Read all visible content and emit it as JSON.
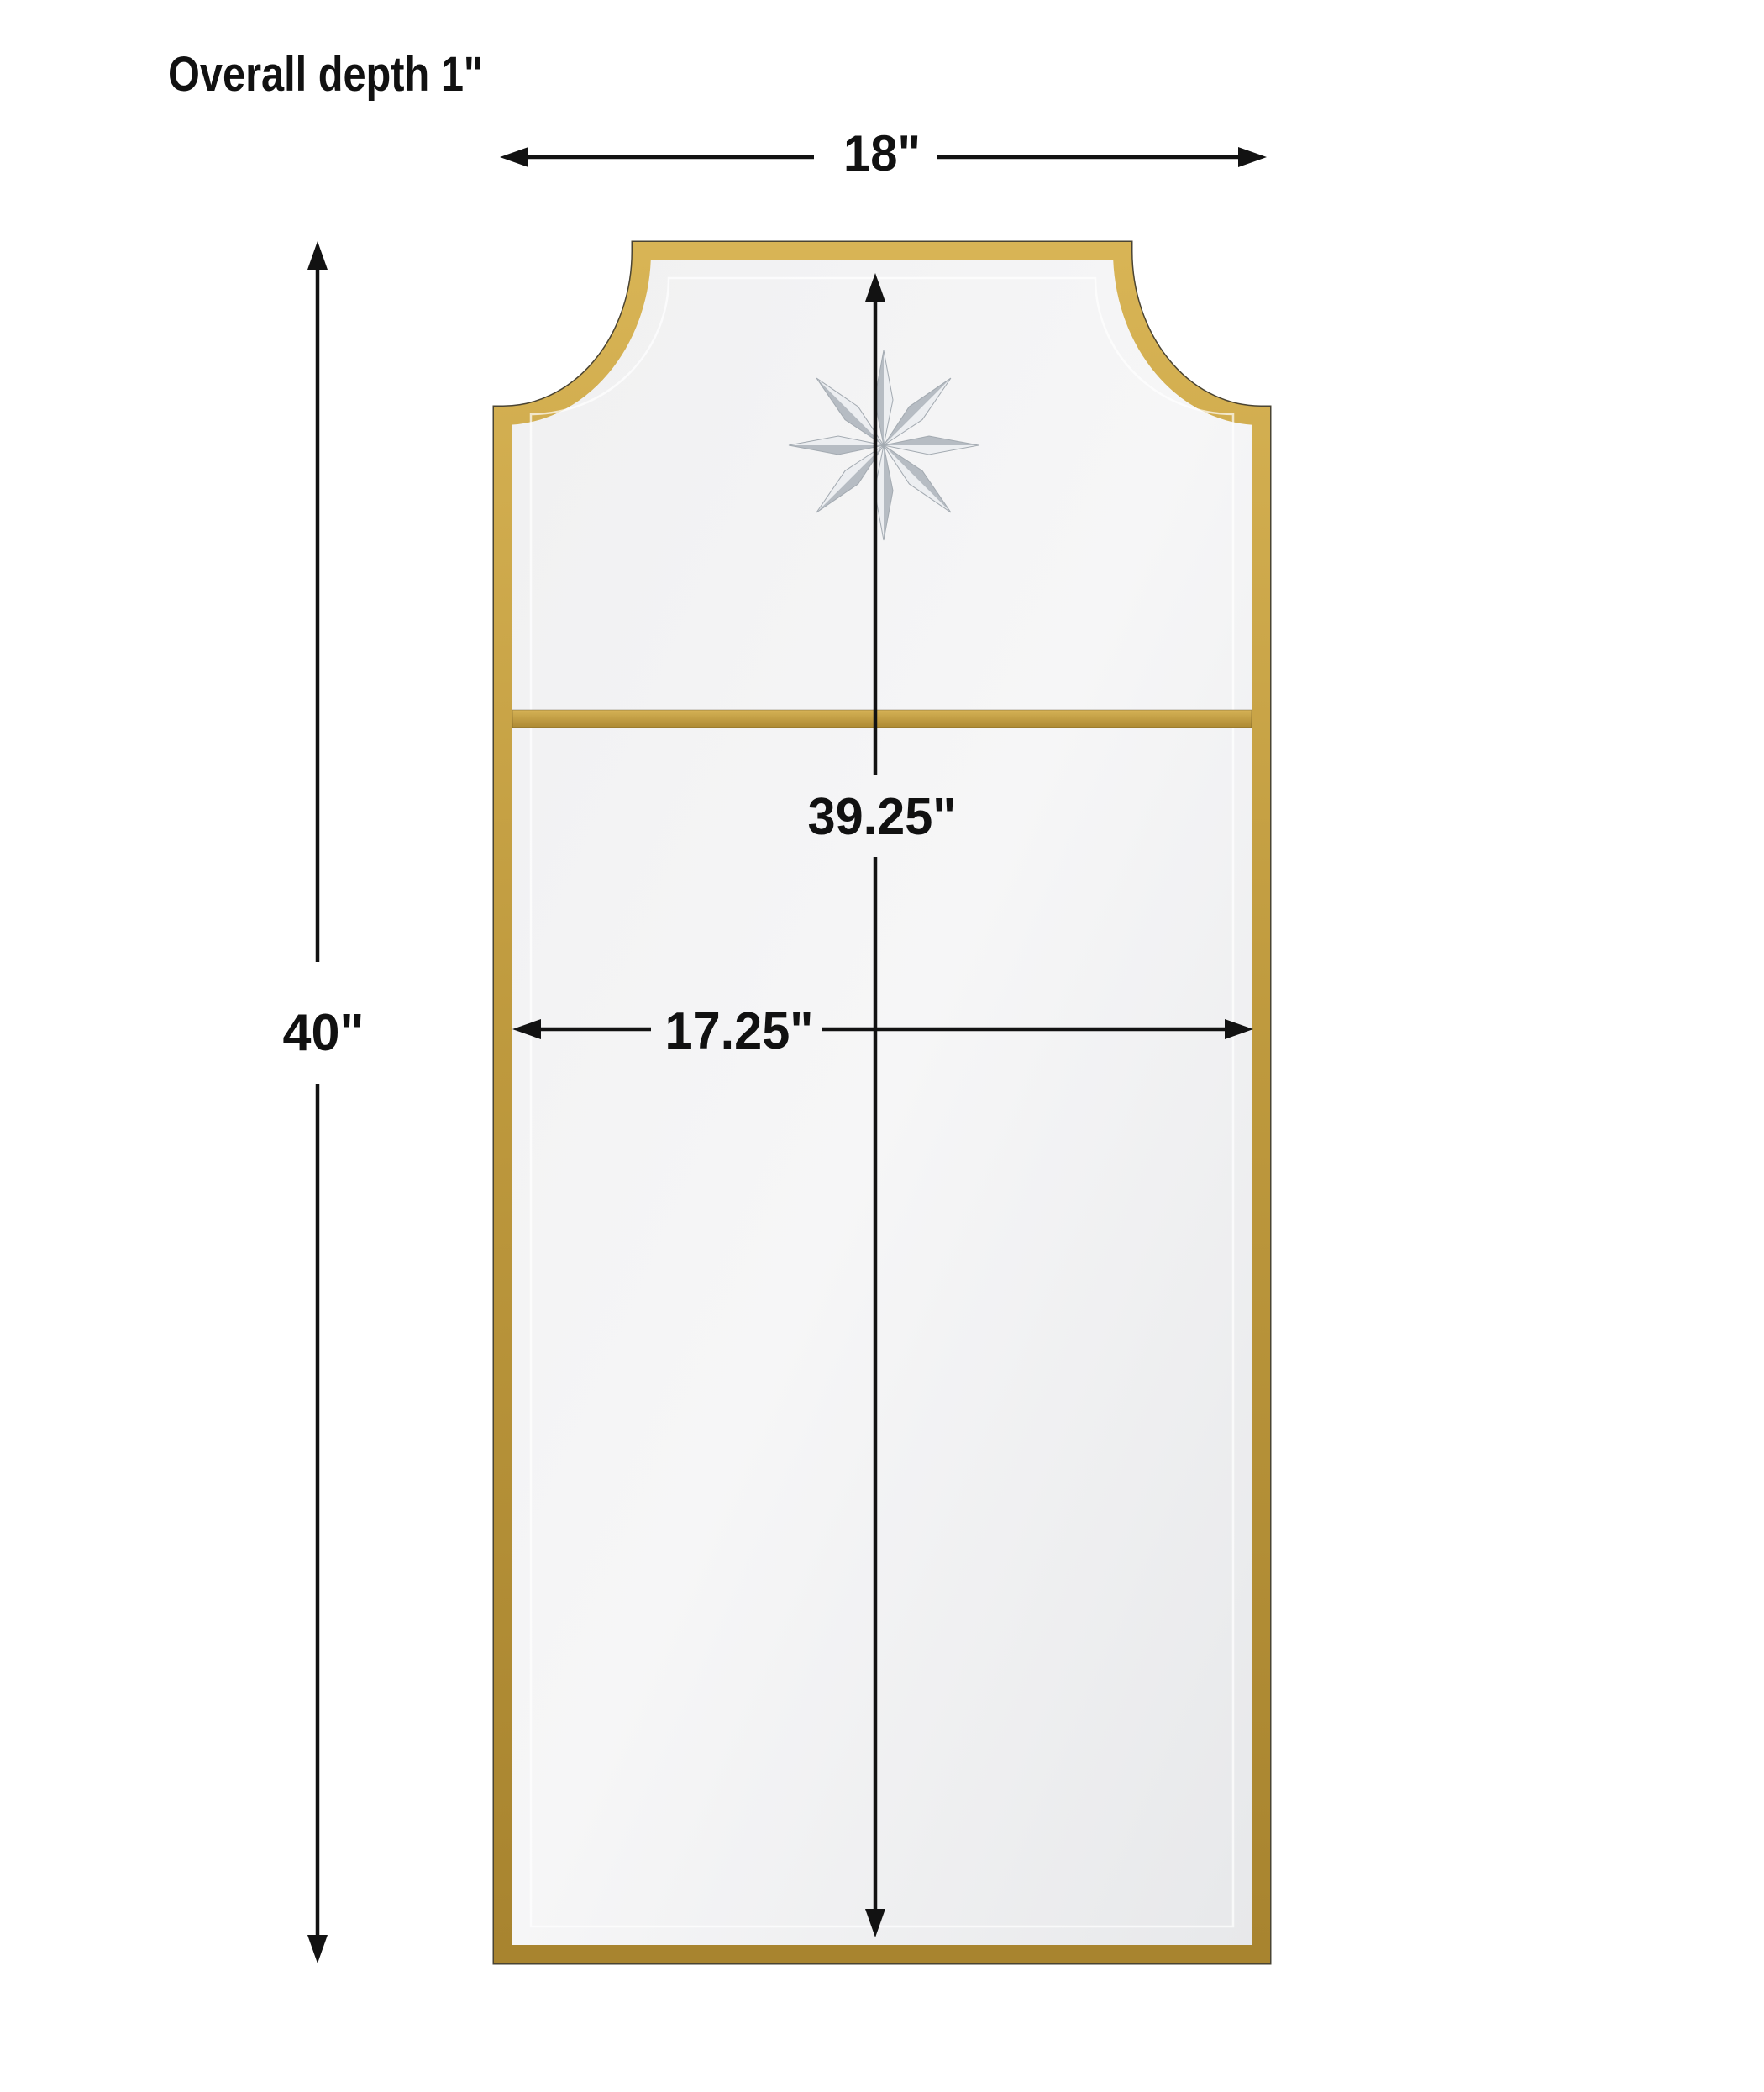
{
  "diagram": {
    "title": "Overall depth 1\"",
    "labels": {
      "overall_width": "18\"",
      "overall_height": "40\"",
      "inner_height": "39.25\"",
      "inner_width": "17.25\""
    },
    "colors": {
      "background": "#ffffff",
      "dimension_line": "#121212",
      "frame_gold_light": "#d8b455",
      "frame_gold_mid": "#bf9a3e",
      "frame_gold_dark": "#a8842f",
      "divider_gold_light": "#d6b256",
      "divider_gold_dark": "#ad8a33",
      "glass_light": "#f6f6f7",
      "glass_dark": "#e7e8ea",
      "star_etch_dark": "#b6bcc3",
      "star_etch_light": "#eceef1"
    }
  }
}
